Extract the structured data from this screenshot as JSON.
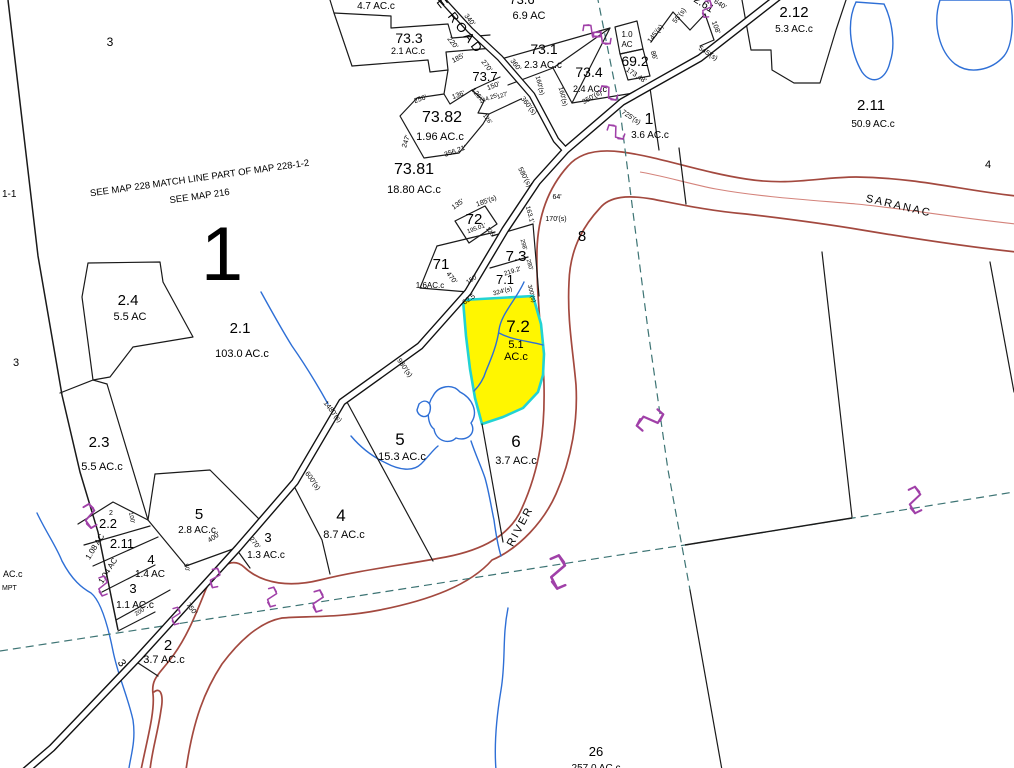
{
  "map": {
    "colors": {
      "background": "#ffffff",
      "boundary": "#1a1a1a",
      "road_casing": "#111111",
      "river": "#a3493f",
      "river_center": "#d4837b",
      "water": "#2e6fd6",
      "dashed": "#3d7474",
      "symbol": "#a040a8",
      "highlight_fill": "#fff600",
      "highlight_stroke": "#22d3d3"
    },
    "highlighted_parcel": {
      "id": "7.2",
      "acres": "5.1",
      "unit": "AC.c"
    },
    "labels": [
      {
        "text": "3",
        "x": 110,
        "y": 46,
        "size": 12
      },
      {
        "text": "1-1",
        "x": 2,
        "y": 197,
        "size": 10,
        "anchor": "start"
      },
      {
        "text": "SEE MAP 228  MATCH LINE  PART OF MAP 228-1-2",
        "x": 200,
        "y": 181,
        "size": 9.5,
        "rot": -8
      },
      {
        "text": "SEE  MAP  216",
        "x": 200,
        "y": 199,
        "size": 9.5,
        "rot": -8
      },
      {
        "text": "1",
        "x": 222,
        "y": 280,
        "size": 76
      },
      {
        "text": "4.7 AC.c",
        "x": 376,
        "y": 9,
        "size": 10
      },
      {
        "text": "73.6",
        "x": 522,
        "y": 4,
        "size": 13
      },
      {
        "text": "6.9 AC",
        "x": 529,
        "y": 19,
        "size": 11
      },
      {
        "text": "E  ROAD",
        "x": 436,
        "y": 2,
        "size": 13,
        "rot": 52,
        "ls": 3,
        "anchor": "start"
      },
      {
        "text": "340'",
        "x": 468,
        "y": 21,
        "size": 7,
        "rot": 52
      },
      {
        "text": "220'",
        "x": 451,
        "y": 44,
        "size": 7,
        "rot": 52
      },
      {
        "text": "73.3",
        "x": 409,
        "y": 43,
        "size": 14
      },
      {
        "text": "2.1 AC.c",
        "x": 408,
        "y": 54,
        "size": 9
      },
      {
        "text": "73.1",
        "x": 544,
        "y": 54,
        "size": 14
      },
      {
        "text": "2.3 AC.c",
        "x": 543,
        "y": 68,
        "size": 10
      },
      {
        "text": "185'",
        "x": 459,
        "y": 60,
        "size": 7,
        "rot": -28
      },
      {
        "text": "270'",
        "x": 485,
        "y": 67,
        "size": 7,
        "rot": 52
      },
      {
        "text": "360'",
        "x": 514,
        "y": 66,
        "size": 7,
        "rot": 52
      },
      {
        "text": "73.7",
        "x": 485,
        "y": 81,
        "size": 13
      },
      {
        "text": "73.4",
        "x": 589,
        "y": 77,
        "size": 14
      },
      {
        "text": "2.4 AC.c",
        "x": 590,
        "y": 92,
        "size": 9
      },
      {
        "text": "160'(s)",
        "x": 538,
        "y": 86,
        "size": 6.5,
        "rot": 75
      },
      {
        "text": "160'(s)",
        "x": 561,
        "y": 97,
        "size": 6.5,
        "rot": 75
      },
      {
        "text": "350'(s)",
        "x": 593,
        "y": 99,
        "size": 7,
        "rot": -30
      },
      {
        "text": "1.0",
        "x": 627,
        "y": 37,
        "size": 8
      },
      {
        "text": "AC",
        "x": 627,
        "y": 47,
        "size": 8
      },
      {
        "text": "69.2",
        "x": 635,
        "y": 66,
        "size": 14
      },
      {
        "text": "145'(s)",
        "x": 657,
        "y": 35,
        "size": 7,
        "rot": -52
      },
      {
        "text": "55'(s)",
        "x": 681,
        "y": 17,
        "size": 7,
        "rot": -52
      },
      {
        "text": "108'",
        "x": 714,
        "y": 28,
        "size": 7,
        "rot": 70
      },
      {
        "text": "86'",
        "x": 652,
        "y": 56,
        "size": 7,
        "rot": 70
      },
      {
        "text": "173.48'",
        "x": 635,
        "y": 77,
        "size": 7,
        "rot": 33
      },
      {
        "text": "640'",
        "x": 719,
        "y": 6,
        "size": 7,
        "rot": 33
      },
      {
        "text": "2.61",
        "x": 702,
        "y": 7,
        "size": 11,
        "rot": 33
      },
      {
        "text": "545'(s)",
        "x": 707,
        "y": 55,
        "size": 7,
        "rot": 33
      },
      {
        "text": "725'(s)",
        "x": 630,
        "y": 119,
        "size": 7,
        "rot": 33
      },
      {
        "text": "1",
        "x": 649,
        "y": 124,
        "size": 16
      },
      {
        "text": "3.6 AC.c",
        "x": 650,
        "y": 138,
        "size": 10
      },
      {
        "text": "256'",
        "x": 421,
        "y": 101,
        "size": 7,
        "rot": -20
      },
      {
        "text": "136'",
        "x": 459,
        "y": 97,
        "size": 7,
        "rot": -20
      },
      {
        "text": "126'",
        "x": 475,
        "y": 95,
        "size": 7,
        "rot": 52
      },
      {
        "text": "150'",
        "x": 494,
        "y": 88,
        "size": 7,
        "rot": -20
      },
      {
        "text": "144.25'",
        "x": 489,
        "y": 100,
        "size": 6,
        "rot": -20
      },
      {
        "text": "127'",
        "x": 503,
        "y": 97,
        "size": 6,
        "rot": -20
      },
      {
        "text": "360'(s)",
        "x": 527,
        "y": 107,
        "size": 7,
        "rot": 52
      },
      {
        "text": "73.82",
        "x": 442,
        "y": 122,
        "size": 16
      },
      {
        "text": "1.96 AC.c",
        "x": 440,
        "y": 140,
        "size": 11
      },
      {
        "text": "247'",
        "x": 408,
        "y": 142,
        "size": 7,
        "rot": -72
      },
      {
        "text": "356.21'",
        "x": 456,
        "y": 153,
        "size": 7,
        "rot": -20
      },
      {
        "text": "126'",
        "x": 486,
        "y": 120,
        "size": 6,
        "rot": 52
      },
      {
        "text": "73.81",
        "x": 414,
        "y": 174,
        "size": 16
      },
      {
        "text": "18.80 AC.c",
        "x": 414,
        "y": 193,
        "size": 11
      },
      {
        "text": "2.12",
        "x": 794,
        "y": 17,
        "size": 15
      },
      {
        "text": "5.3 AC.c",
        "x": 794,
        "y": 32,
        "size": 10
      },
      {
        "text": "2.11",
        "x": 871,
        "y": 110,
        "size": 15
      },
      {
        "text": "50.9 AC.c",
        "x": 873,
        "y": 127,
        "size": 10
      },
      {
        "text": "4",
        "x": 988,
        "y": 168,
        "size": 11
      },
      {
        "text": "SARANAC",
        "x": 898,
        "y": 209,
        "size": 11,
        "rot": 13,
        "ls": 2
      },
      {
        "text": "185'(s)",
        "x": 487,
        "y": 203,
        "size": 7,
        "rot": -20
      },
      {
        "text": "72",
        "x": 474,
        "y": 224,
        "size": 15
      },
      {
        "text": "135'",
        "x": 459,
        "y": 206,
        "size": 7,
        "rot": -35
      },
      {
        "text": "195.01'",
        "x": 477,
        "y": 230,
        "size": 6,
        "rot": -20
      },
      {
        "text": "126'",
        "x": 489,
        "y": 233,
        "size": 6,
        "rot": 52
      },
      {
        "text": "580'(s)",
        "x": 523,
        "y": 178,
        "size": 7,
        "rot": 62
      },
      {
        "text": "64'",
        "x": 557,
        "y": 199,
        "size": 7
      },
      {
        "text": "170'(s)",
        "x": 556,
        "y": 221,
        "size": 7
      },
      {
        "text": "163.1'",
        "x": 528,
        "y": 215,
        "size": 6.5,
        "rot": 75
      },
      {
        "text": "8",
        "x": 582,
        "y": 241,
        "size": 15
      },
      {
        "text": "71",
        "x": 441,
        "y": 269,
        "size": 15
      },
      {
        "text": "470'",
        "x": 450,
        "y": 279,
        "size": 7,
        "rot": 52
      },
      {
        "text": "1.6AC.c",
        "x": 430,
        "y": 288,
        "size": 8
      },
      {
        "text": "7.3",
        "x": 516,
        "y": 261,
        "size": 15
      },
      {
        "text": "219.2'",
        "x": 513,
        "y": 273,
        "size": 6.5,
        "rot": -18
      },
      {
        "text": "298'",
        "x": 522,
        "y": 245,
        "size": 6,
        "rot": 75
      },
      {
        "text": "280'",
        "x": 528,
        "y": 265,
        "size": 6,
        "rot": 75
      },
      {
        "text": "7.1",
        "x": 505,
        "y": 284,
        "size": 13
      },
      {
        "text": "150'",
        "x": 473,
        "y": 281,
        "size": 6.5,
        "rot": -35
      },
      {
        "text": "324'(s)",
        "x": 503,
        "y": 293,
        "size": 6.5,
        "rot": -15
      },
      {
        "text": "300'(s)",
        "x": 530,
        "y": 294,
        "size": 6,
        "rot": 75
      },
      {
        "text": "62.5",
        "x": 470,
        "y": 301,
        "size": 7,
        "rot": -35
      },
      {
        "text": "7.2",
        "x": 518,
        "y": 332,
        "size": 17
      },
      {
        "text": "5.1",
        "x": 516,
        "y": 348,
        "size": 11
      },
      {
        "text": "AC.c",
        "x": 516,
        "y": 360,
        "size": 11
      },
      {
        "text": "980'(s)",
        "x": 403,
        "y": 369,
        "size": 7,
        "rot": 55
      },
      {
        "text": "1480'(s)",
        "x": 331,
        "y": 413,
        "size": 7,
        "rot": 52
      },
      {
        "text": "5",
        "x": 400,
        "y": 445,
        "size": 17
      },
      {
        "text": "15.3 AC.c",
        "x": 402,
        "y": 460,
        "size": 11
      },
      {
        "text": "6",
        "x": 516,
        "y": 447,
        "size": 17
      },
      {
        "text": "3.7 AC.c",
        "x": 516,
        "y": 464,
        "size": 11
      },
      {
        "text": "600'(s)",
        "x": 311,
        "y": 482,
        "size": 7,
        "rot": 55
      },
      {
        "text": "4",
        "x": 341,
        "y": 521,
        "size": 17
      },
      {
        "text": "8.7 AC.c",
        "x": 344,
        "y": 538,
        "size": 11
      },
      {
        "text": "RIVER",
        "x": 523,
        "y": 528,
        "size": 11,
        "rot": -62,
        "ls": 2
      },
      {
        "text": "2.4",
        "x": 128,
        "y": 305,
        "size": 15
      },
      {
        "text": "5.5 AC",
        "x": 130,
        "y": 320,
        "size": 11
      },
      {
        "text": "2.1",
        "x": 240,
        "y": 333,
        "size": 15
      },
      {
        "text": "103.0 AC.c",
        "x": 242,
        "y": 357,
        "size": 11
      },
      {
        "text": "3",
        "x": 16,
        "y": 366,
        "size": 11
      },
      {
        "text": "2.3",
        "x": 99,
        "y": 447,
        "size": 15
      },
      {
        "text": "5.5 AC.c",
        "x": 102,
        "y": 470,
        "size": 11
      },
      {
        "text": "AC.c",
        "x": 3,
        "y": 577,
        "size": 9,
        "anchor": "start"
      },
      {
        "text": "MPT",
        "x": 2,
        "y": 590,
        "size": 7,
        "anchor": "start"
      },
      {
        "text": "5",
        "x": 199,
        "y": 519,
        "size": 15
      },
      {
        "text": "2.8 AC.c",
        "x": 197,
        "y": 533,
        "size": 10
      },
      {
        "text": "400'",
        "x": 215,
        "y": 539,
        "size": 7,
        "rot": -35
      },
      {
        "text": "3",
        "x": 268,
        "y": 542,
        "size": 13
      },
      {
        "text": "1.3 AC.c",
        "x": 266,
        "y": 558,
        "size": 10
      },
      {
        "text": "270'",
        "x": 253,
        "y": 544,
        "size": 7,
        "rot": 52
      },
      {
        "text": "2",
        "x": 111,
        "y": 515,
        "size": 7
      },
      {
        "text": "100'",
        "x": 130,
        "y": 518,
        "size": 6,
        "rot": 80
      },
      {
        "text": "2.2",
        "x": 108,
        "y": 528,
        "size": 13
      },
      {
        "text": "2.11",
        "x": 122,
        "y": 548,
        "size": 13
      },
      {
        "text": "1.08 AC",
        "x": 97,
        "y": 548,
        "size": 8,
        "rot": -58
      },
      {
        "text": "1.04 AC",
        "x": 110,
        "y": 572,
        "size": 8,
        "rot": -58
      },
      {
        "text": "4",
        "x": 151,
        "y": 564,
        "size": 13
      },
      {
        "text": "1.4 AC",
        "x": 150,
        "y": 577,
        "size": 10
      },
      {
        "text": "50'",
        "x": 185,
        "y": 568,
        "size": 6,
        "rot": 75
      },
      {
        "text": "200'",
        "x": 141,
        "y": 613,
        "size": 6,
        "rot": -32
      },
      {
        "text": "3",
        "x": 133,
        "y": 593,
        "size": 13
      },
      {
        "text": "1.1 AC.c",
        "x": 135,
        "y": 608,
        "size": 10
      },
      {
        "text": "750'",
        "x": 190,
        "y": 610,
        "size": 7,
        "rot": 52
      },
      {
        "text": "2",
        "x": 168,
        "y": 650,
        "size": 15
      },
      {
        "text": "3.7 AC.c",
        "x": 164,
        "y": 663,
        "size": 11
      },
      {
        "text": "3",
        "x": 119,
        "y": 665,
        "size": 11,
        "rot": 55
      },
      {
        "text": "26",
        "x": 596,
        "y": 756,
        "size": 13
      },
      {
        "text": "257.0 AC.c",
        "x": 596,
        "y": 771,
        "size": 10
      }
    ],
    "symbols": [
      {
        "x": 707,
        "y": 9,
        "rot": 25,
        "scale": 0.8
      },
      {
        "x": 592,
        "y": 31,
        "rot": -50,
        "scale": 0.9
      },
      {
        "x": 602,
        "y": 38,
        "rot": -50,
        "scale": 0.9
      },
      {
        "x": 609,
        "y": 93,
        "rot": -40,
        "scale": 0.9
      },
      {
        "x": 616,
        "y": 132,
        "rot": -40,
        "scale": 0.9
      },
      {
        "x": 650,
        "y": 420,
        "rot": 72,
        "scale": 1.3
      },
      {
        "x": 915,
        "y": 500,
        "rot": 5,
        "scale": 1.2
      },
      {
        "x": 558,
        "y": 572,
        "rot": 8,
        "scale": 1.5
      },
      {
        "x": 318,
        "y": 601,
        "rot": 15,
        "scale": 1.0
      },
      {
        "x": 272,
        "y": 597,
        "rot": 15,
        "scale": 0.9
      },
      {
        "x": 215,
        "y": 578,
        "rot": 20,
        "scale": 0.9
      },
      {
        "x": 176,
        "y": 616,
        "rot": 15,
        "scale": 0.8
      },
      {
        "x": 90,
        "y": 516,
        "rot": 0,
        "scale": 1.1
      },
      {
        "x": 103,
        "y": 586,
        "rot": 10,
        "scale": 0.9
      }
    ]
  }
}
